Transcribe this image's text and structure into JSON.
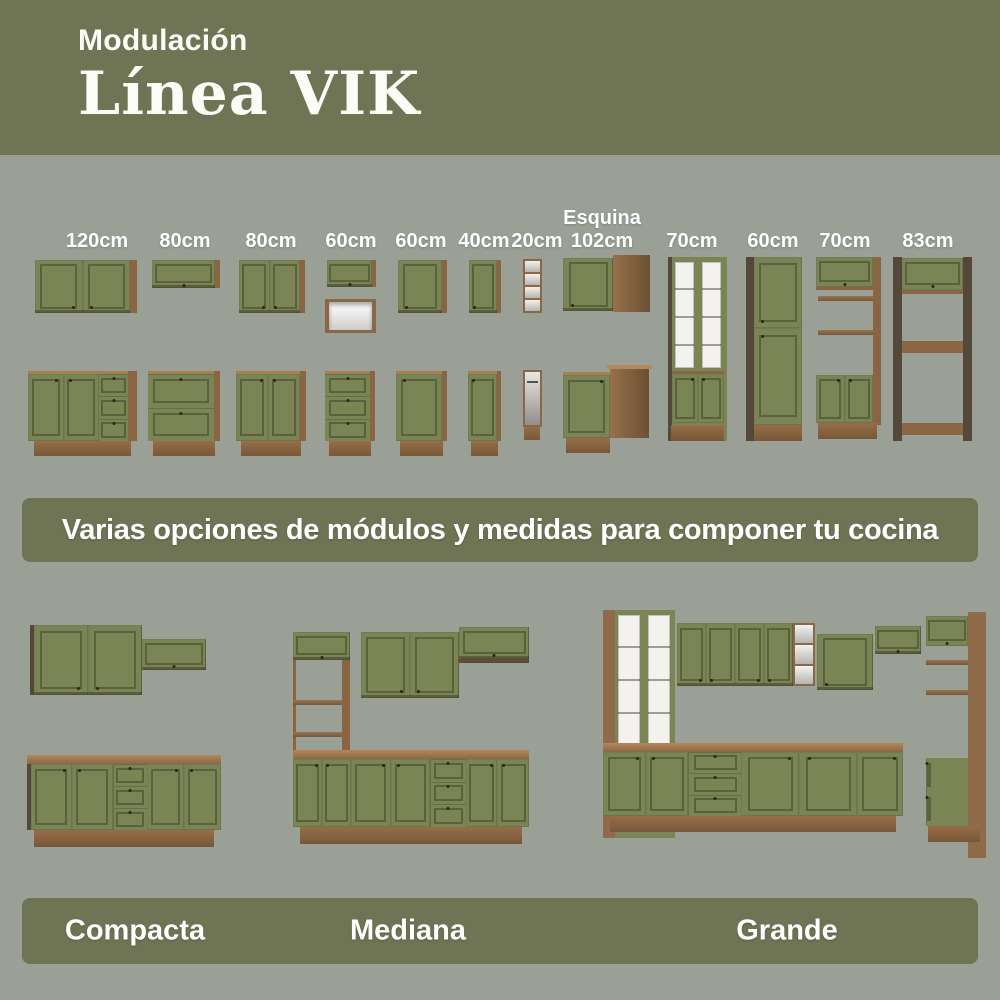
{
  "header": {
    "kicker": "Modulación",
    "title": "Línea VIK"
  },
  "banner": {
    "text": "Varias opciones de módulos y medidas para componer tu cocina"
  },
  "modules": [
    {
      "label": "120cm",
      "shape": "wall-2-door + base-2-door-3-drawer"
    },
    {
      "label": "80cm",
      "shape": "wall-flip-up + base-2-drawer"
    },
    {
      "label": "80cm",
      "shape": "wall-2-door + base-2-door"
    },
    {
      "label": "60cm",
      "shape": "wall-flip-up-with-niche + base-3-drawer"
    },
    {
      "label": "60cm",
      "shape": "wall-1-door + base-1-door"
    },
    {
      "label": "40cm",
      "shape": "wall-1-door + base-1-door"
    },
    {
      "label": "20cm",
      "shape": "open-shelf + towel-rail-unit"
    },
    {
      "label": "Esquina\n102cm",
      "shape": "corner-wall + corner-base"
    },
    {
      "label": "70cm",
      "shape": "tall-glass-display"
    },
    {
      "label": "60cm",
      "shape": "tall-pantry"
    },
    {
      "label": "70cm",
      "shape": "tall-open-tower"
    },
    {
      "label": "83cm",
      "shape": "tall-oven-tower"
    }
  ],
  "kitchens": [
    {
      "label": "Compacta"
    },
    {
      "label": "Mediana"
    },
    {
      "label": "Grande"
    }
  ],
  "colors": {
    "olive": "#6F7454",
    "background": "#9AA096",
    "cabinet_green": "#7A8455",
    "wood": "#8A6544",
    "wood_dark": "#54483A",
    "white_interior": "#F2F1EE",
    "text": "#FFFFFF"
  }
}
